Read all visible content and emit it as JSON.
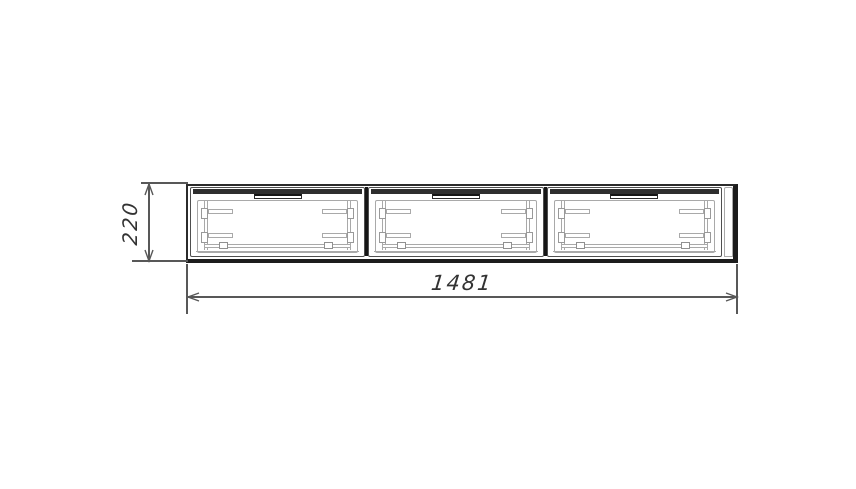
{
  "colors": {
    "background": "#ffffff",
    "outline_dark": "#1c1c1c",
    "outline_mid": "#4f4f4f",
    "detail_light": "#a9a9a9",
    "dimension": "#585858",
    "text": "#333333"
  },
  "cabinet": {
    "drawer_count": 3
  },
  "dimensions": {
    "width": {
      "label": "1481"
    },
    "height": {
      "label": "220"
    }
  }
}
